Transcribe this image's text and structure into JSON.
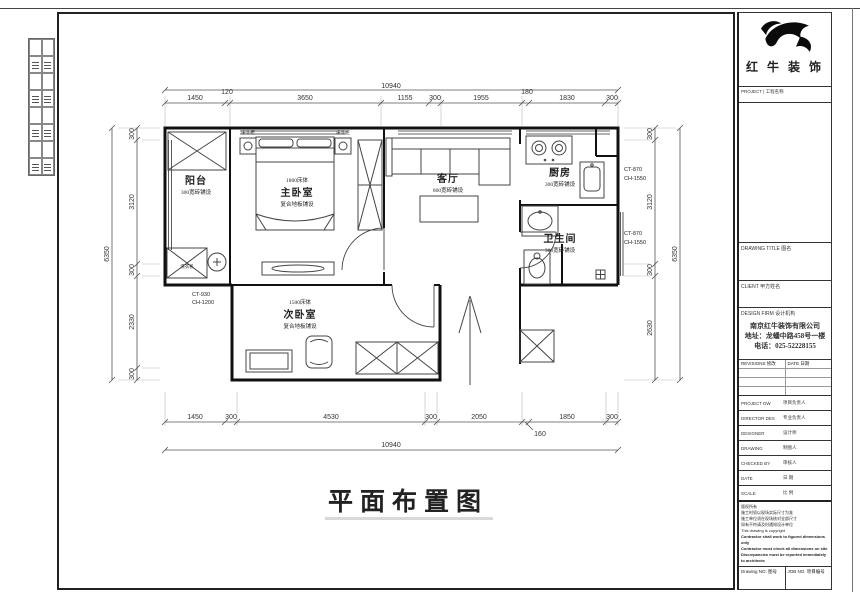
{
  "brand": {
    "company_cn": "红 牛 装 饰"
  },
  "titleblock": {
    "project_label": "PROJECT | 工程名称",
    "drawing_title_label": "DRAWING TITLE 图名",
    "client_label": "CLIENT 甲方姓名",
    "design_firm_label": "DESIGN FIRM 设计机构",
    "company_name": "南京红牛装饰有限公司",
    "company_address": "地址：龙蟠中路458号一楼",
    "company_phone": "电话：025-52228155",
    "revisions_label": "REVISIONS 修改",
    "revisions_date_label": "DATE 日期",
    "info_rows": [
      {
        "label": "PROJECT DW",
        "value": "项目负责人"
      },
      {
        "label": "DIRECTOR DES",
        "value": "专业负责人"
      },
      {
        "label": "DESIGNER",
        "value": "设计师"
      },
      {
        "label": "DRAWING",
        "value": "制图人"
      },
      {
        "label": "CHECKED BY",
        "value": "审核人"
      },
      {
        "label": "DATE",
        "value": "日  期"
      },
      {
        "label": "SCALE",
        "value": "比  例"
      }
    ],
    "notes": [
      "版权所有",
      "施工时须以现场实际尺寸为准",
      "施工单位须在现场核对全部尺寸",
      "如有不符请及时通知设计单位",
      "This drawing is copyright",
      "Contractor shall work to figured dimensions only",
      "Contractor must check all dimensions on site",
      "Discrepancies must be reported immediately to architects"
    ],
    "drawing_no_label": "Drawing NO. 图号",
    "job_no_label": "JOB NO. 项目编号"
  },
  "plan": {
    "title": "平面布置图",
    "rooms": {
      "balcony": {
        "name": "阳台",
        "finish": "300宽砖铺设"
      },
      "master": {
        "size": "1800床体",
        "name": "主卧室",
        "finish": "复合地板铺设"
      },
      "living": {
        "name": "客厅",
        "finish": "800宽砖铺设"
      },
      "kitchen": {
        "name": "厨房",
        "finish": "300宽砖铺设"
      },
      "bath": {
        "name": "卫生间",
        "finish": "300宽砖铺设"
      },
      "second": {
        "size": "1500床体",
        "name": "次卧室",
        "finish": "复合地板铺设"
      }
    },
    "furniture": {
      "washer": "洗衣机",
      "nightstand_left": "床头柜",
      "nightstand_right": "床头柜"
    },
    "tags": {
      "balcony_ct": "CT-930",
      "balcony_ch": "CH-1200",
      "kitchen_ct": "CT-870",
      "kitchen_ch": "CH-1550",
      "bath_ct": "CT-870",
      "bath_ch": "CH-1550"
    },
    "dims": {
      "top_total": "10940",
      "top": [
        "1450",
        "120",
        "3650",
        "1155",
        "300",
        "1955",
        "180",
        "1830",
        "300"
      ],
      "bottom": [
        "1450",
        "300",
        "4530",
        "300",
        "2050",
        "160",
        "1850",
        "300"
      ],
      "bottom_total": "10940",
      "left": [
        "300",
        "3120",
        "300",
        "2330",
        "300"
      ],
      "left_total": "6350",
      "right": [
        "300",
        "3120",
        "300",
        "2630"
      ],
      "right_total": "6350"
    }
  }
}
